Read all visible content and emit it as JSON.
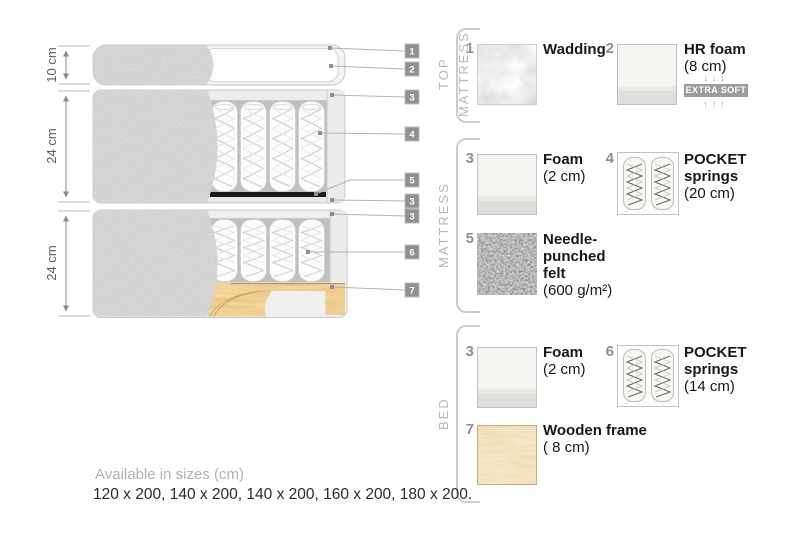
{
  "diagram": {
    "dim_labels": [
      "10 cm",
      "24 cm",
      "24 cm"
    ],
    "tags": [
      "1",
      "2",
      "3",
      "4",
      "5",
      "3",
      "3",
      "6",
      "7"
    ]
  },
  "legend": {
    "sections": [
      {
        "title": "TOP MATTRESS"
      },
      {
        "title": "MATTRESS"
      },
      {
        "title": "BED"
      }
    ],
    "items": [
      {
        "num": "1",
        "name_lines": [
          "Wadding"
        ],
        "sub": "",
        "swatch": "wadding-swatch"
      },
      {
        "num": "2",
        "name_lines": [
          "HR foam"
        ],
        "sub": "(8 cm)",
        "swatch": "foam-swatch",
        "extra": {
          "down": "↓↓↓",
          "label": "EXTRA SOFT",
          "up": "↑↑↑"
        }
      },
      {
        "num": "3",
        "name_lines": [
          "Foam"
        ],
        "sub": "(2 cm)",
        "swatch": "foam-swatch"
      },
      {
        "num": "4",
        "name_lines": [
          "POCKET",
          "springs"
        ],
        "sub": "(20 cm)",
        "swatch": "pocket-springs-swatch"
      },
      {
        "num": "5",
        "name_lines": [
          "Needle-",
          "punched",
          "felt"
        ],
        "sub": "(600 g/m²)",
        "swatch": "felt-swatch"
      },
      {
        "num": "3",
        "name_lines": [
          "Foam"
        ],
        "sub": "(2 cm)",
        "swatch": "foam-swatch"
      },
      {
        "num": "6",
        "name_lines": [
          "POCKET",
          "springs"
        ],
        "sub": "(14 cm)",
        "swatch": "pocket-springs-swatch"
      },
      {
        "num": "7",
        "name_lines": [
          "Wooden frame"
        ],
        "sub": "( 8  cm)",
        "swatch": "wood-swatch"
      }
    ]
  },
  "footer": {
    "sizes_title": "Available in sizes (cm)",
    "sizes_list": "120 x 200, 140 x 200, 140 x 200, 160 x 200, 180 x 200."
  },
  "colors": {
    "fabric_gray": "#9d9d9d",
    "foam_light": "#f4f4f1",
    "felt_band": "#191917",
    "wood": "#dfa54e",
    "tag_bg": "#909090",
    "badge_bg": "#9c9c9c",
    "line_gray": "#b3b3b3"
  }
}
